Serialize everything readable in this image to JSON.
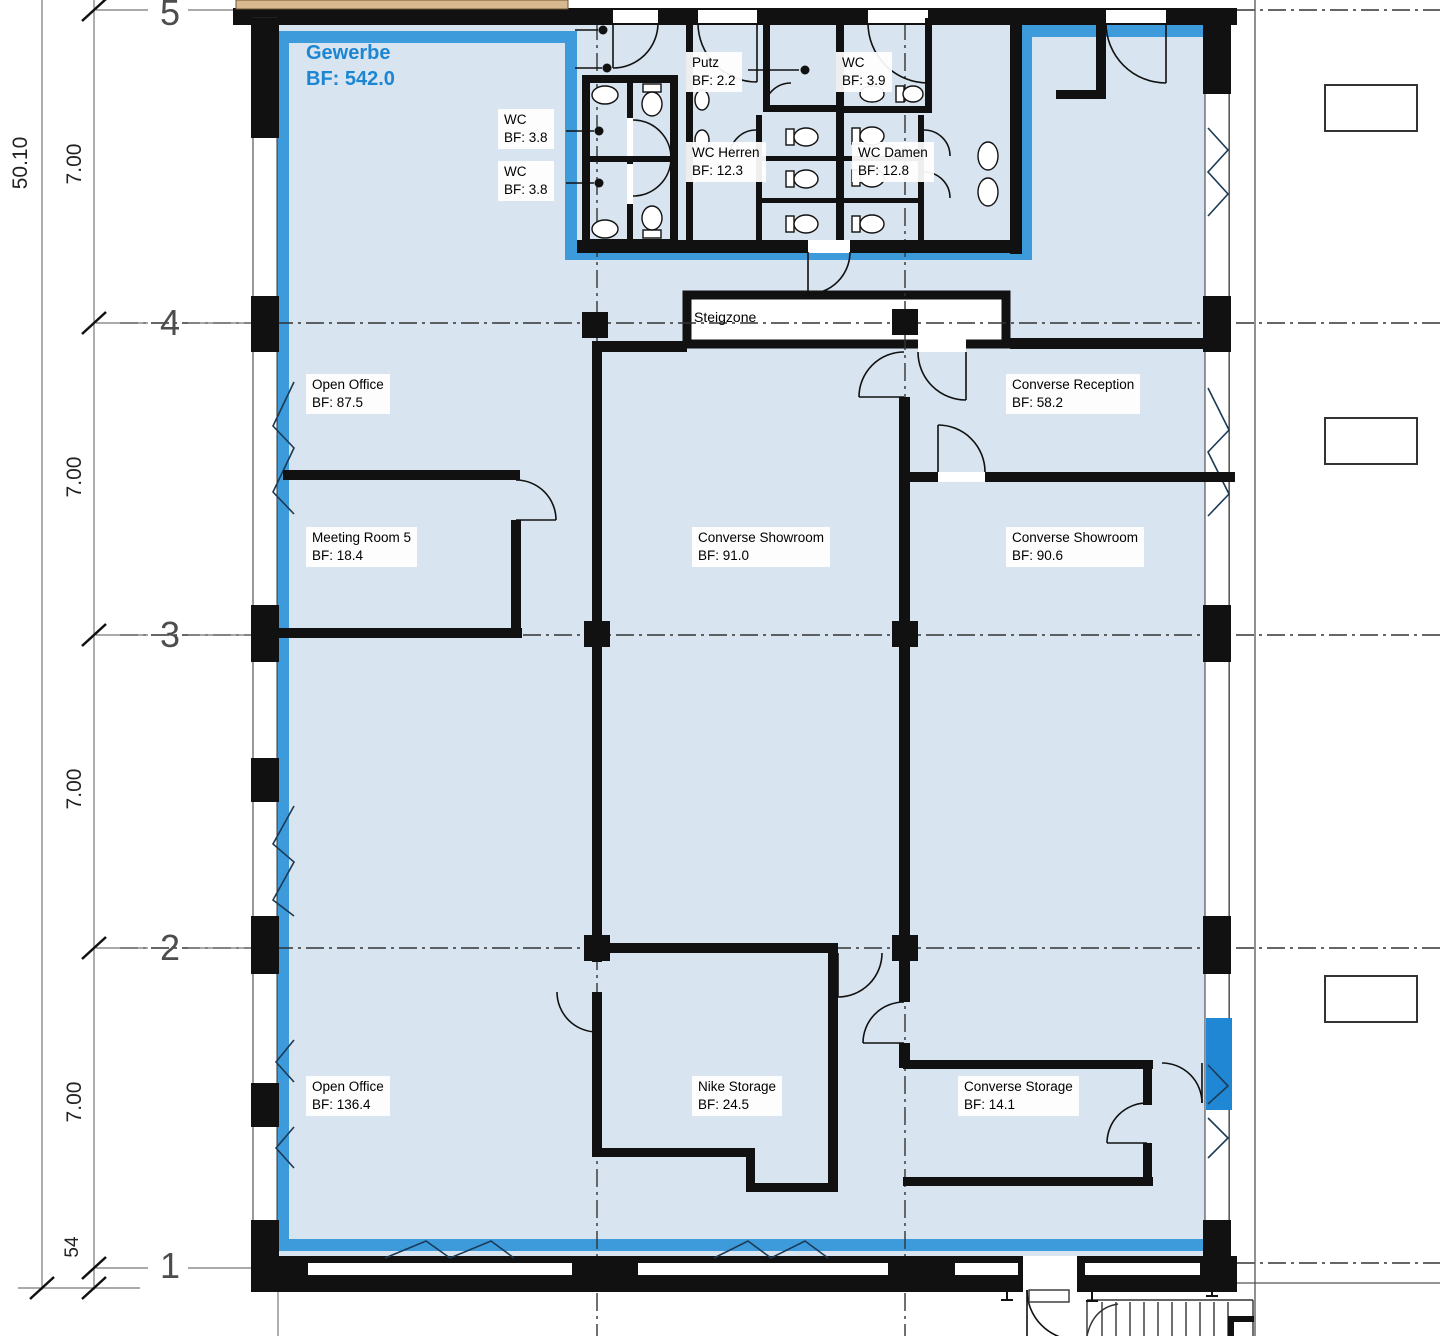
{
  "plan": {
    "lease": {
      "name": "Gewerbe",
      "area": "BF: 542.0"
    },
    "rooms": [
      {
        "name": "Open Office",
        "area": "BF: 87.5"
      },
      {
        "name": "Meeting Room 5",
        "area": "BF: 18.4"
      },
      {
        "name": "Converse Showroom",
        "area": "BF: 91.0"
      },
      {
        "name": "Converse Reception",
        "area": "BF: 58.2"
      },
      {
        "name": "Converse Showroom",
        "area": "BF: 90.6"
      },
      {
        "name": "Open Office",
        "area": "BF: 136.4"
      },
      {
        "name": "Nike Storage",
        "area": "BF: 24.5"
      },
      {
        "name": "Converse Storage",
        "area": "BF: 14.1"
      },
      {
        "name": "WC",
        "area": "BF: 3.8"
      },
      {
        "name": "WC",
        "area": "BF: 3.8"
      },
      {
        "name": "Putz",
        "area": "BF: 2.2"
      },
      {
        "name": "WC",
        "area": "BF: 3.9"
      },
      {
        "name": "WC Herren",
        "area": "BF: 12.3"
      },
      {
        "name": "WC Damen",
        "area": "BF: 12.8"
      }
    ],
    "core": {
      "steigzone": "Steigzone"
    },
    "grid": {
      "axes": [
        "5",
        "4",
        "3",
        "2",
        "1"
      ]
    },
    "dimensions": {
      "overall": "50.10",
      "bays": [
        "7.00",
        "7.00",
        "7.00",
        "7.00"
      ],
      "base_offset": "54"
    },
    "colors": {
      "lease_highlight": "#3D9BDC",
      "floor_fill": "#D8E4EF",
      "glazing_panel": "#1F87D3",
      "wall": "#111111",
      "timber_wall": "#D8B88E",
      "label_accent": "#1C86D4"
    }
  }
}
